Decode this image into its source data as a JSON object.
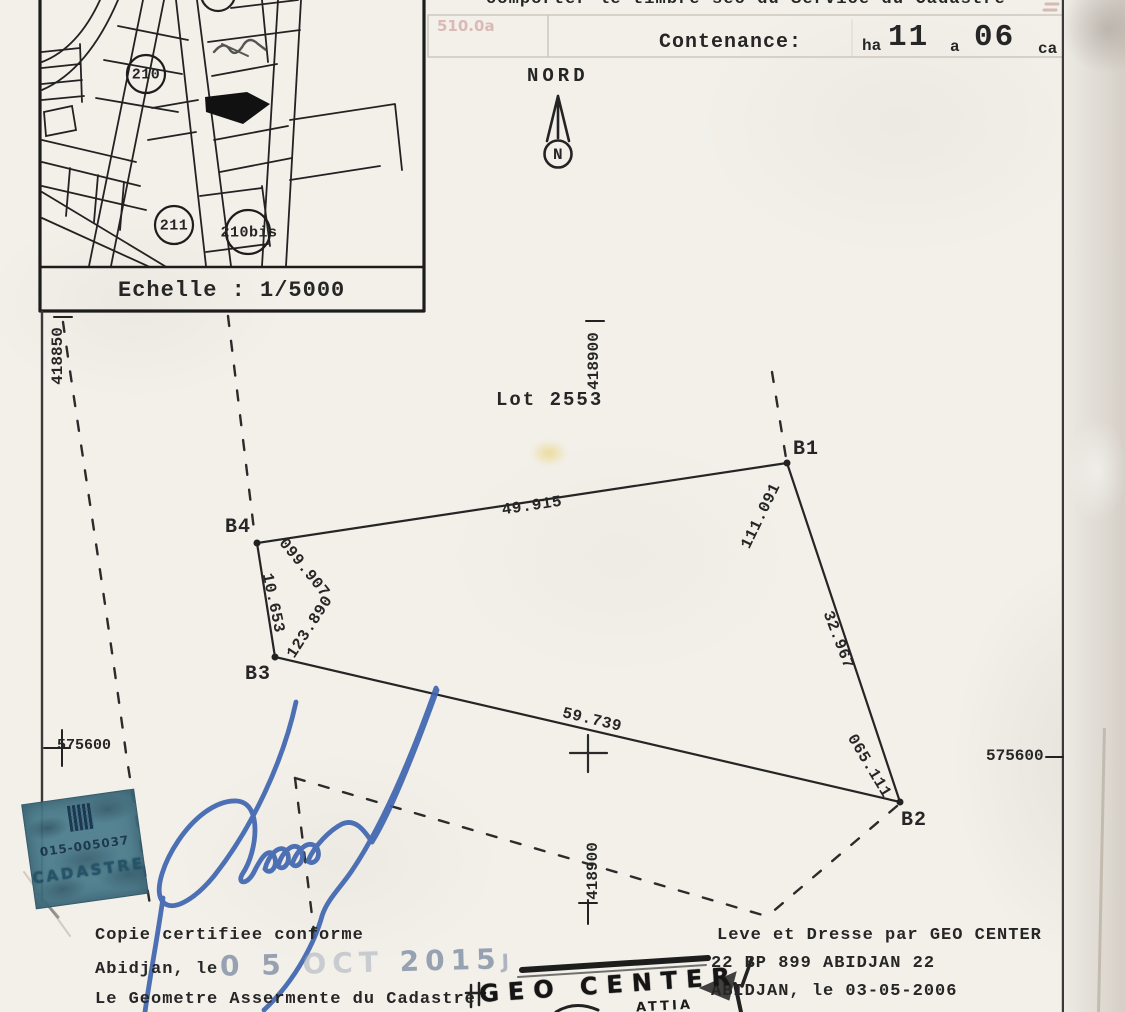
{
  "colors": {
    "paper": "#f3f0ea",
    "ink": "#262626",
    "signature_blue": "#4066b0",
    "stamp_teal": "#4d7e8d",
    "date_stamp_gray": "#96a1b1"
  },
  "header": {
    "instruction_line": "comporter le timbre sec du Service du Cadastre",
    "ghost_text": "510.0a"
  },
  "contenance": {
    "label": "Contenance:",
    "ha_label": "ha",
    "ha_value": "11",
    "a_label": "a",
    "a_value": "06",
    "ca_label": "ca"
  },
  "inset_map": {
    "scale_label": "Echelle : 1/5000",
    "parcel_210": "210",
    "parcel_211": "211",
    "parcel_210bis": "210bis"
  },
  "north": {
    "label": "NORD",
    "letter": "N"
  },
  "plan": {
    "lot_label": "Lot 2553",
    "points": {
      "b1": "B1",
      "b2": "B2",
      "b3": "B3",
      "b4": "B4"
    },
    "measurements": {
      "top": "49.915",
      "b1_bearing": "111.091",
      "b4_bearing": "099.907",
      "left": "10.653",
      "b3_bearing": "123.890",
      "bottom": "59.739",
      "right_dist": "32.967",
      "b2_bearing": "065.111"
    },
    "grid": {
      "northing_left": "418850",
      "easting_top": "418900",
      "easting_bottom": "418900",
      "y_left": "575600",
      "y_right": "575600"
    }
  },
  "stamps": {
    "cadastre": {
      "number": "015-005037",
      "title": "CADASTRE"
    },
    "date": {
      "day": "0 5",
      "month": "OCT",
      "year": "2015",
      "suffix": "J"
    },
    "geo": {
      "name": "GEO CENTER",
      "sub": "ATTIA"
    }
  },
  "footer_left": {
    "line1": "Copie certifiee conforme",
    "line2": "Abidjan, le",
    "line3": "Le Geometre Assermente du Cadastre"
  },
  "footer_right": {
    "line1": "Leve et Dresse par GEO CENTER",
    "line2": "22 BP 899 ABIDJAN 22",
    "line3": "ABIDJAN, le 03-05-2006"
  }
}
